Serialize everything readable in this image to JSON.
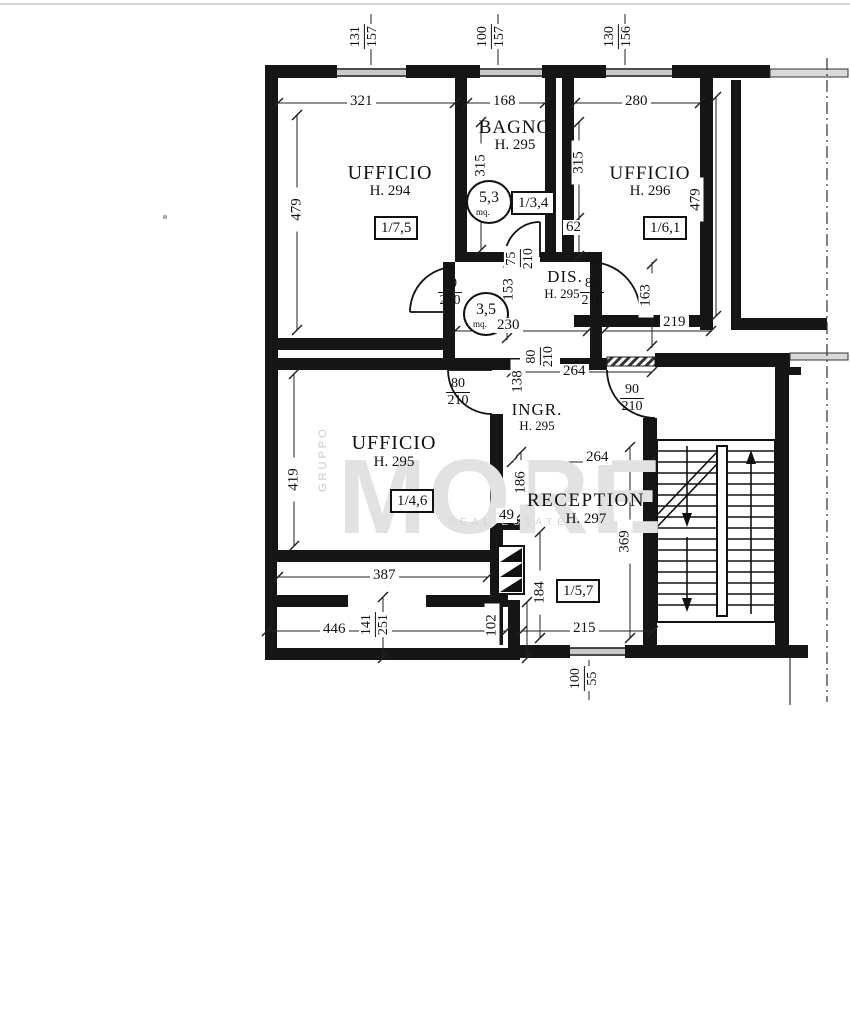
{
  "watermark": {
    "side": "GRUPPO",
    "brand": "MORE",
    "tagline": "REAL ESTATE"
  },
  "rooms": {
    "ufficio_294": {
      "label": "UFFICIO",
      "height": "H. 294",
      "ref": "1/7,5"
    },
    "bagno": {
      "label": "BAGNO",
      "height": "H. 295",
      "area": "5,3",
      "unit": "mq.",
      "ref": "1/3,4"
    },
    "ufficio_296": {
      "label": "UFFICIO",
      "height": "H. 296",
      "ref": "1/6,1"
    },
    "dis": {
      "label": "DIS.",
      "height": "H. 295",
      "area": "3,5",
      "unit": "mq."
    },
    "ufficio_295": {
      "label": "UFFICIO",
      "height": "H. 295",
      "ref": "1/4,6"
    },
    "ingresso": {
      "label": "INGR.",
      "height": "H. 295"
    },
    "reception": {
      "label": "RECEPTION",
      "height": "H. 297",
      "ref": "1/5,7"
    }
  },
  "dims": {
    "win1_w": "131",
    "win1_h": "157",
    "win2_w": "100",
    "win2_h": "157",
    "win3_w": "130",
    "win3_h": "156",
    "u294_w": "321",
    "bagno_w": "168",
    "u296_w": "280",
    "left_h": "479",
    "bagno_h": "315",
    "u296_h": "315",
    "right_h": "479",
    "seg_62": "62",
    "bagno_door_w": "75",
    "bagno_door_h": "210",
    "dis_len": "153",
    "seg_163": "163",
    "dis_door_left_w": "80",
    "dis_door_left_h": "210",
    "dis_door_right_w": "80",
    "dis_door_right_h": "210",
    "dis_w": "230",
    "corr_219": "219",
    "ingr_w": "264",
    "pass_w": "80",
    "pass_h": "210",
    "seg_138": "138",
    "ingr_door_w": "80",
    "ingr_door_h": "210",
    "entry_door_w": "90",
    "entry_door_h": "210",
    "rec_w": "264",
    "seg_186": "186",
    "seg_49": "49",
    "rec_h": "369",
    "seg_184": "184",
    "rec_s_w": "215",
    "win4_w": "100",
    "win4_h": "55",
    "u295_h": "419",
    "u295_w": "387",
    "ext_446": "446",
    "ext_141": "141",
    "ext_251": "251",
    "ext_102": "102"
  }
}
